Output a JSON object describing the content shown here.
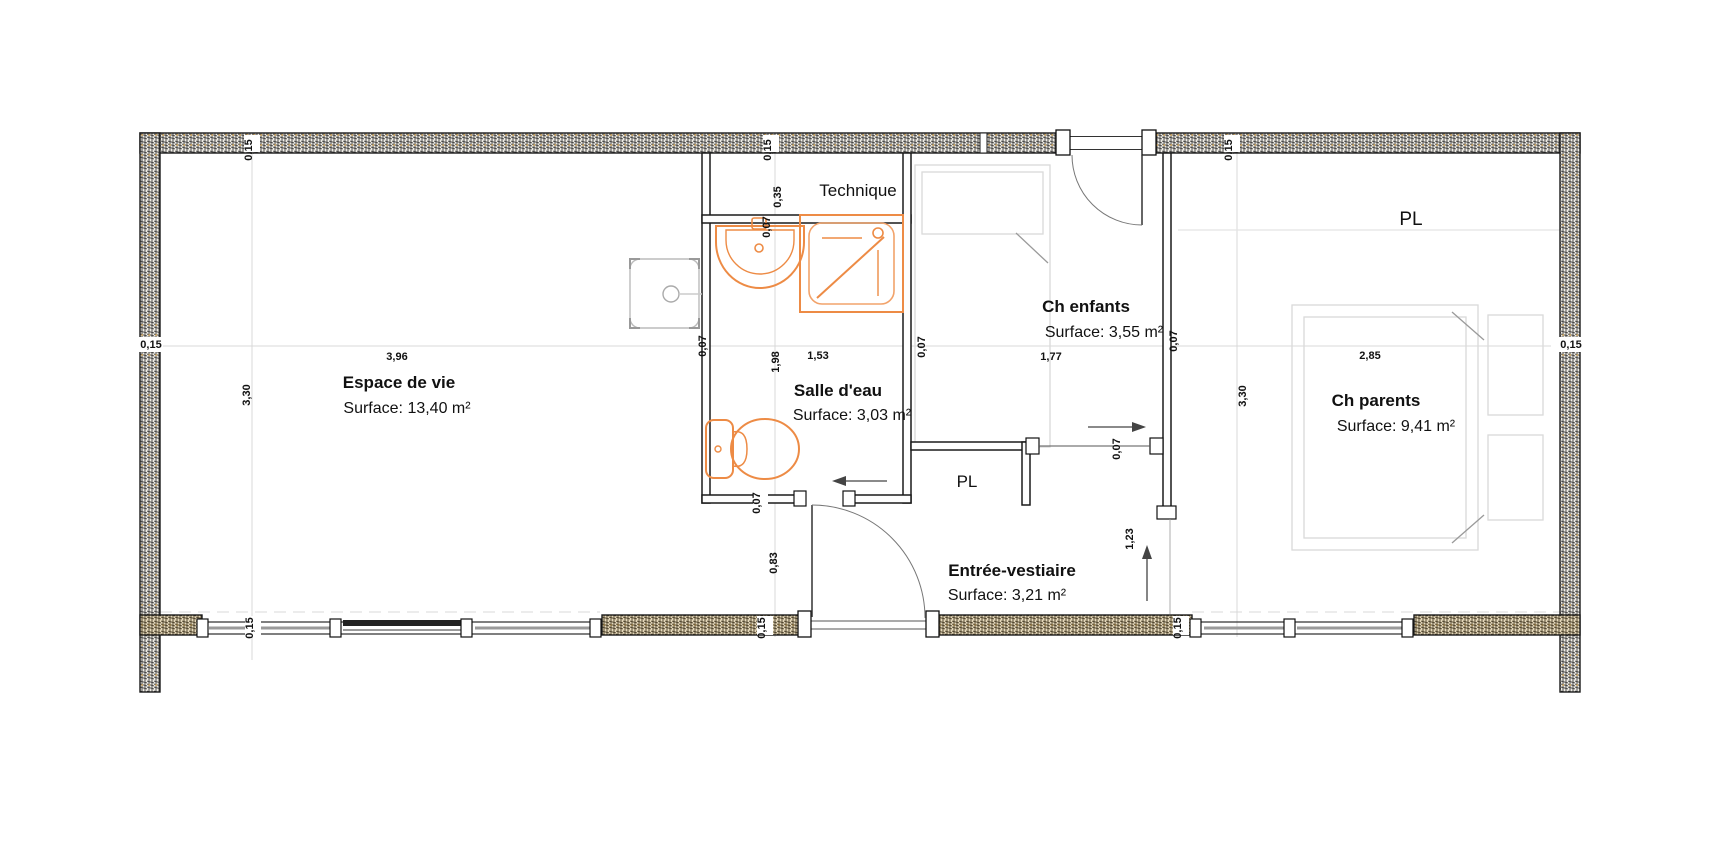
{
  "rooms": [
    {
      "name": "Espace de vie",
      "surface": "Surface: 13,40 m²"
    },
    {
      "name": "Salle d'eau",
      "surface": "Surface: 3,03 m²"
    },
    {
      "name": "Ch enfants",
      "surface": "Surface: 3,55 m²"
    },
    {
      "name": "Ch parents",
      "surface": "Surface: 9,41 m²"
    },
    {
      "name": "Entrée-vestiaire",
      "surface": "Surface: 3,21 m²"
    },
    {
      "name": "Technique",
      "surface": ""
    }
  ],
  "closets": {
    "label": "PL"
  },
  "dims": {
    "d015": "0,15",
    "d007": "0,07",
    "d035": "0,35",
    "d083": "0,83",
    "d123": "1,23",
    "d153": "1,53",
    "d177": "1,77",
    "d198": "1,98",
    "d285": "2,85",
    "d330": "3,30",
    "d396": "3,96"
  },
  "colors": {
    "fixture_orange": "#ed8b45",
    "fixture_orange_light": "#f2a36b",
    "wall_line": "#1a1a1a",
    "hatch_dot": "#c8a05a",
    "furniture_gray": "#d9d9d9"
  }
}
